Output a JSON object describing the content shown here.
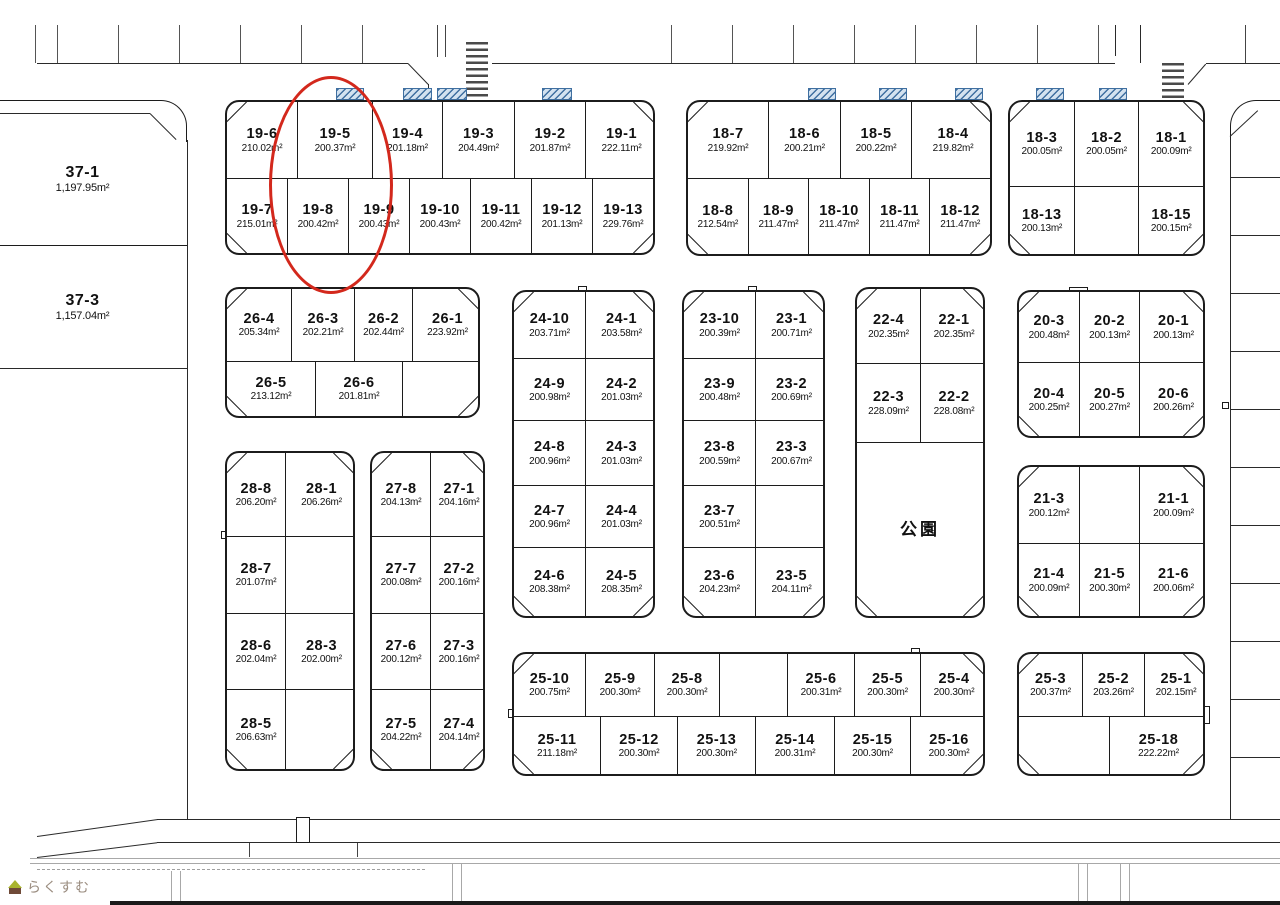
{
  "map": {
    "area_unit": "m²",
    "highlight": {
      "lot": "19-5",
      "color": "#d3281c",
      "x": 269,
      "y": 76,
      "w": 124,
      "h": 218
    },
    "hatch_marks": [
      {
        "x": 336,
        "w": 28
      },
      {
        "x": 403,
        "w": 29
      },
      {
        "x": 437,
        "w": 30
      },
      {
        "x": 542,
        "w": 30
      },
      {
        "x": 808,
        "w": 28
      },
      {
        "x": 879,
        "w": 28
      },
      {
        "x": 955,
        "w": 28
      },
      {
        "x": 1036,
        "w": 28
      },
      {
        "x": 1099,
        "w": 28
      }
    ],
    "park_label": "公園",
    "blocks": [
      {
        "id": "37",
        "style": "open",
        "x": 0,
        "y": 113,
        "w": 187,
        "h": 255,
        "rows": [
          {
            "h": 132,
            "cells": [
              {
                "id": "37-1",
                "area": "1,197.95"
              }
            ]
          },
          {
            "h": 123,
            "cells": [
              {
                "id": "37-3",
                "area": "1,157.04"
              }
            ]
          }
        ]
      },
      {
        "id": "19",
        "x": 225,
        "y": 100,
        "w": 430,
        "h": 155,
        "rows": [
          {
            "h": 78,
            "cells": [
              {
                "id": "19-6",
                "area": "210.02",
                "w": 70
              },
              {
                "id": "19-5",
                "area": "200.37",
                "w": 75
              },
              {
                "id": "19-4",
                "area": "201.18",
                "w": 70
              },
              {
                "id": "19-3",
                "area": "204.49",
                "w": 72
              },
              {
                "id": "19-2",
                "area": "201.87",
                "w": 71
              },
              {
                "id": "19-1",
                "area": "222.11",
                "w": 72
              }
            ]
          },
          {
            "h": 77,
            "cells": [
              {
                "id": "19-7",
                "area": "215.01"
              },
              {
                "id": "19-8",
                "area": "200.42"
              },
              {
                "id": "19-9",
                "area": "200.43"
              },
              {
                "id": "19-10",
                "area": "200.43"
              },
              {
                "id": "19-11",
                "area": "200.42"
              },
              {
                "id": "19-12",
                "area": "201.13"
              },
              {
                "id": "19-13",
                "area": "229.76"
              }
            ]
          }
        ]
      },
      {
        "id": "18-left",
        "x": 686,
        "y": 100,
        "w": 306,
        "h": 156,
        "rows": [
          {
            "h": 78,
            "cells": [
              {
                "id": "18-7",
                "area": "219.92",
                "w": 80
              },
              {
                "id": "18-6",
                "area": "200.21",
                "w": 72
              },
              {
                "id": "18-5",
                "area": "200.22",
                "w": 71
              },
              {
                "id": "18-4",
                "area": "219.82",
                "w": 83
              }
            ]
          },
          {
            "h": 78,
            "cells": [
              {
                "id": "18-8",
                "area": "212.54"
              },
              {
                "id": "18-9",
                "area": "211.47"
              },
              {
                "id": "18-10",
                "area": "211.47"
              },
              {
                "id": "18-11",
                "area": "211.47"
              },
              {
                "id": "18-12",
                "area": "211.47"
              }
            ]
          }
        ]
      },
      {
        "id": "18-right",
        "x": 1008,
        "y": 100,
        "w": 197,
        "h": 156,
        "rows": [
          {
            "h": 86,
            "cells": [
              {
                "id": "18-3",
                "area": "200.05"
              },
              {
                "id": "18-2",
                "area": "200.05"
              },
              {
                "id": "18-1",
                "area": "200.09"
              }
            ]
          },
          {
            "h": 70,
            "cells": [
              {
                "id": "18-13",
                "area": "200.13"
              },
              {
                "id": null
              },
              {
                "id": "18-15",
                "area": "200.15"
              }
            ]
          }
        ]
      },
      {
        "id": "26",
        "x": 225,
        "y": 287,
        "w": 255,
        "h": 131,
        "rows": [
          {
            "h": 74,
            "cells": [
              {
                "id": "26-4",
                "area": "205.34",
                "w": 64
              },
              {
                "id": "26-3",
                "area": "202.21",
                "w": 63
              },
              {
                "id": "26-2",
                "area": "202.44",
                "w": 58
              },
              {
                "id": "26-1",
                "area": "223.92",
                "w": 70
              }
            ]
          },
          {
            "h": 57,
            "cells": [
              {
                "id": "26-5",
                "area": "213.12",
                "w": 88
              },
              {
                "id": "26-6",
                "area": "201.81",
                "w": 87
              },
              {
                "id": null,
                "w": 80
              }
            ]
          }
        ]
      },
      {
        "id": "24",
        "x": 512,
        "y": 290,
        "w": 143,
        "h": 328,
        "rows": [
          {
            "h": 67,
            "cells": [
              {
                "id": "24-10",
                "area": "203.71",
                "w": 71
              },
              {
                "id": "24-1",
                "area": "203.58",
                "w": 72
              }
            ]
          },
          {
            "h": 63,
            "cells": [
              {
                "id": "24-9",
                "area": "200.98",
                "w": 71
              },
              {
                "id": "24-2",
                "area": "201.03",
                "w": 72
              }
            ]
          },
          {
            "h": 65,
            "cells": [
              {
                "id": "24-8",
                "area": "200.96",
                "w": 71
              },
              {
                "id": "24-3",
                "area": "201.03",
                "w": 72
              }
            ]
          },
          {
            "h": 63,
            "cells": [
              {
                "id": "24-7",
                "area": "200.96",
                "w": 71
              },
              {
                "id": "24-4",
                "area": "201.03",
                "w": 72
              }
            ]
          },
          {
            "h": 70,
            "cells": [
              {
                "id": "24-6",
                "area": "208.38",
                "w": 71
              },
              {
                "id": "24-5",
                "area": "208.35",
                "w": 72
              }
            ]
          }
        ]
      },
      {
        "id": "23",
        "x": 682,
        "y": 290,
        "w": 143,
        "h": 328,
        "rows": [
          {
            "h": 67,
            "cells": [
              {
                "id": "23-10",
                "area": "200.39",
                "w": 71
              },
              {
                "id": "23-1",
                "area": "200.71",
                "w": 72
              }
            ]
          },
          {
            "h": 63,
            "cells": [
              {
                "id": "23-9",
                "area": "200.48",
                "w": 71
              },
              {
                "id": "23-2",
                "area": "200.69",
                "w": 72
              }
            ]
          },
          {
            "h": 65,
            "cells": [
              {
                "id": "23-8",
                "area": "200.59",
                "w": 71
              },
              {
                "id": "23-3",
                "area": "200.67",
                "w": 72
              }
            ]
          },
          {
            "h": 63,
            "cells": [
              {
                "id": "23-7",
                "area": "200.51",
                "w": 71
              },
              {
                "id": null,
                "w": 72
              }
            ]
          },
          {
            "h": 70,
            "cells": [
              {
                "id": "23-6",
                "area": "204.23",
                "w": 71
              },
              {
                "id": "23-5",
                "area": "204.11",
                "w": 72
              }
            ]
          }
        ]
      },
      {
        "id": "22",
        "x": 855,
        "y": 287,
        "w": 130,
        "h": 331,
        "rows": [
          {
            "h": 75,
            "cells": [
              {
                "id": "22-4",
                "area": "202.35",
                "w": 63
              },
              {
                "id": "22-1",
                "area": "202.35",
                "w": 67
              }
            ]
          },
          {
            "h": 80,
            "cells": [
              {
                "id": "22-3",
                "area": "228.09",
                "w": 63
              },
              {
                "id": "22-2",
                "area": "228.08",
                "w": 67
              }
            ]
          },
          {
            "h": 176,
            "cells": [
              {
                "park": true
              }
            ]
          }
        ]
      },
      {
        "id": "20",
        "x": 1017,
        "y": 290,
        "w": 188,
        "h": 148,
        "rows": [
          {
            "h": 72,
            "cells": [
              {
                "id": "20-3",
                "area": "200.48",
                "w": 60
              },
              {
                "id": "20-2",
                "area": "200.13",
                "w": 60
              },
              {
                "id": "20-1",
                "area": "200.13",
                "w": 68
              }
            ]
          },
          {
            "h": 76,
            "cells": [
              {
                "id": "20-4",
                "area": "200.25",
                "w": 60
              },
              {
                "id": "20-5",
                "area": "200.27",
                "w": 60
              },
              {
                "id": "20-6",
                "area": "200.26",
                "w": 68
              }
            ]
          }
        ]
      },
      {
        "id": "21",
        "x": 1017,
        "y": 465,
        "w": 188,
        "h": 153,
        "rows": [
          {
            "h": 78,
            "cells": [
              {
                "id": "21-3",
                "area": "200.12",
                "w": 60
              },
              {
                "id": null,
                "w": 60
              },
              {
                "id": "21-1",
                "area": "200.09",
                "w": 68
              }
            ]
          },
          {
            "h": 75,
            "cells": [
              {
                "id": "21-4",
                "area": "200.09",
                "w": 60
              },
              {
                "id": "21-5",
                "area": "200.30",
                "w": 60
              },
              {
                "id": "21-6",
                "area": "200.06",
                "w": 68
              }
            ]
          }
        ]
      },
      {
        "id": "28",
        "x": 225,
        "y": 451,
        "w": 130,
        "h": 320,
        "rows": [
          {
            "h": 84,
            "cells": [
              {
                "id": "28-8",
                "area": "206.20",
                "w": 58
              },
              {
                "id": "28-1",
                "area": "206.26",
                "w": 72
              }
            ]
          },
          {
            "h": 78,
            "cells": [
              {
                "id": "28-7",
                "area": "201.07",
                "w": 58
              },
              {
                "id": null,
                "w": 72
              }
            ]
          },
          {
            "h": 77,
            "cells": [
              {
                "id": "28-6",
                "area": "202.04",
                "w": 58
              },
              {
                "id": "28-3",
                "area": "202.00",
                "w": 72
              }
            ]
          },
          {
            "h": 81,
            "cells": [
              {
                "id": "28-5",
                "area": "206.63",
                "w": 58
              },
              {
                "id": null,
                "w": 72
              }
            ]
          }
        ]
      },
      {
        "id": "27",
        "x": 370,
        "y": 451,
        "w": 115,
        "h": 320,
        "rows": [
          {
            "h": 84,
            "cells": [
              {
                "id": "27-8",
                "area": "204.13",
                "w": 58
              },
              {
                "id": "27-1",
                "area": "204.16",
                "w": 57
              }
            ]
          },
          {
            "h": 78,
            "cells": [
              {
                "id": "27-7",
                "area": "200.08",
                "w": 58
              },
              {
                "id": "27-2",
                "area": "200.16",
                "w": 57
              }
            ]
          },
          {
            "h": 77,
            "cells": [
              {
                "id": "27-6",
                "area": "200.12",
                "w": 58
              },
              {
                "id": "27-3",
                "area": "200.16",
                "w": 57
              }
            ]
          },
          {
            "h": 81,
            "cells": [
              {
                "id": "27-5",
                "area": "204.22",
                "w": 58
              },
              {
                "id": "27-4",
                "area": "204.14",
                "w": 57
              }
            ]
          }
        ]
      },
      {
        "id": "25-left",
        "x": 512,
        "y": 652,
        "w": 473,
        "h": 124,
        "rows": [
          {
            "h": 64,
            "cells": [
              {
                "id": "25-10",
                "area": "200.75",
                "w": 71
              },
              {
                "id": "25-9",
                "area": "200.30",
                "w": 69
              },
              {
                "id": "25-8",
                "area": "200.30",
                "w": 65
              },
              {
                "id": null,
                "w": 68
              },
              {
                "id": "25-6",
                "area": "200.31",
                "w": 67
              },
              {
                "id": "25-5",
                "area": "200.30",
                "w": 66
              },
              {
                "id": "25-4",
                "area": "200.30",
                "w": 67
              }
            ]
          },
          {
            "h": 60,
            "cells": [
              {
                "id": "25-11",
                "area": "211.18",
                "w": 86
              },
              {
                "id": "25-12",
                "area": "200.30",
                "w": 77
              },
              {
                "id": "25-13",
                "area": "200.30",
                "w": 78
              },
              {
                "id": "25-14",
                "area": "200.31",
                "w": 79
              },
              {
                "id": "25-15",
                "area": "200.30",
                "w": 76
              },
              {
                "id": "25-16",
                "area": "200.30",
                "w": 77
              }
            ]
          }
        ]
      },
      {
        "id": "25-right",
        "x": 1017,
        "y": 652,
        "w": 188,
        "h": 124,
        "rows": [
          {
            "h": 64,
            "cells": [
              {
                "id": "25-3",
                "area": "200.37",
                "w": 63
              },
              {
                "id": "25-2",
                "area": "203.26",
                "w": 62
              },
              {
                "id": "25-1",
                "area": "202.15",
                "w": 63
              }
            ]
          },
          {
            "h": 60,
            "cells": [
              {
                "id": null,
                "w": 90
              },
              {
                "id": "25-18",
                "area": "222.22",
                "w": 98
              }
            ]
          }
        ]
      }
    ]
  },
  "logo": {
    "text": "らくすむ"
  }
}
